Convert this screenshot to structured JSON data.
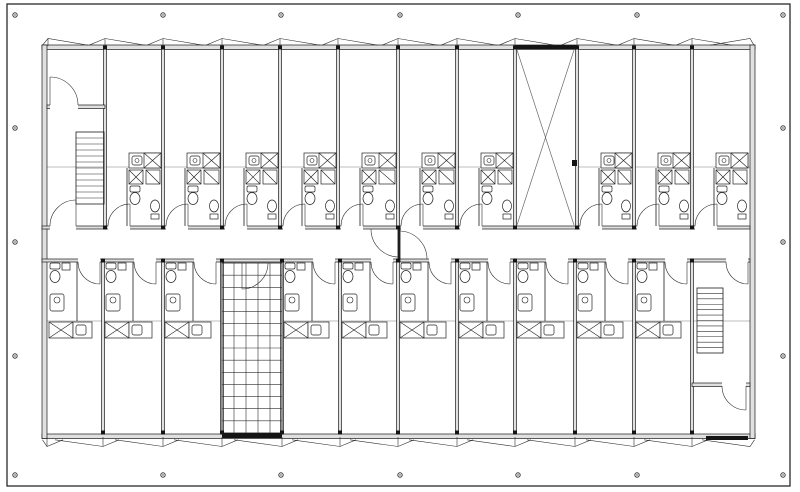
{
  "plan": {
    "kind": "architectural-floor-plan",
    "canvas": {
      "w": 800,
      "h": 492
    },
    "colors": {
      "background": "#ffffff",
      "line": "#1b1b1b",
      "wall_core": "#e0e0e0",
      "guide": "#a6a6a6",
      "solid": "#141414"
    },
    "frame": {
      "x": 7,
      "y": 4,
      "w": 783,
      "h": 482
    },
    "reg_marks": {
      "xs": [
        15,
        163,
        281,
        400,
        518,
        637,
        783
      ],
      "ys": [
        15,
        128,
        242,
        356,
        475
      ],
      "mid_ys": [
        128,
        242,
        356
      ],
      "r": 2.2
    },
    "building": {
      "x1": 42,
      "x2": 755,
      "y1": 45,
      "y2": 438.5,
      "wall_t": 4.5,
      "inner_top": 49,
      "inner_bottom": 434
    },
    "corridor": {
      "top_wall_y": 226,
      "bot_wall_y": 259,
      "wall_t": 3,
      "x1": 42,
      "x2": 750,
      "center_door_x": 397.6,
      "door_r": 28
    },
    "top_walls": [
      105,
      163,
      222,
      280,
      338,
      398,
      457,
      515,
      577,
      634,
      692
    ],
    "bottom_walls": [
      103,
      163,
      222,
      282,
      340,
      398,
      457,
      515,
      575,
      634,
      692
    ],
    "top_rooms": [
      [
        105,
        163
      ],
      [
        163,
        222
      ],
      [
        222,
        280
      ],
      [
        280,
        338
      ],
      [
        338,
        398
      ],
      [
        398,
        457
      ],
      [
        457,
        515
      ],
      [
        577,
        634
      ],
      [
        634,
        692
      ],
      [
        692,
        750
      ]
    ],
    "bottom_rooms": [
      [
        47,
        103
      ],
      [
        103,
        163
      ],
      [
        163,
        222
      ],
      [
        282,
        340
      ],
      [
        340,
        398
      ],
      [
        398,
        457
      ],
      [
        457,
        515
      ],
      [
        515,
        575
      ],
      [
        575,
        634
      ],
      [
        634,
        692
      ]
    ],
    "top_room_door": {
      "off1": 3,
      "off2": 25,
      "r": 22
    },
    "bottom_room_door": {
      "off1": 31,
      "off2": 53,
      "r": 22
    },
    "top_bath_wall_off": 22,
    "bottom_bath_wall_off": 30,
    "shaft": {
      "x1": 515,
      "x2": 577,
      "y1": 49,
      "y2": 225,
      "band_y": 45,
      "band_h": 4,
      "door": [
        572,
        160,
        5,
        6
      ]
    },
    "stair_left": {
      "bay": [
        47,
        105
      ],
      "upper_wall_y": 105,
      "upper_door": {
        "hinge": [
          50,
          105
        ],
        "r": 28
      },
      "flight": [
        76,
        132,
        28,
        72
      ],
      "treads": 11,
      "corr_door": {
        "hinge": [
          76,
          226
        ],
        "r": 26
      }
    },
    "stair_right": {
      "bay": [
        692,
        750
      ],
      "flight": [
        697,
        288,
        26,
        65
      ],
      "treads": 11,
      "corr_door": {
        "hinge": [
          748,
          262
        ],
        "r": 22
      },
      "mid_wall_y": 383,
      "mid_door": {
        "hinge": [
          746,
          386
        ],
        "r": 24
      },
      "solid": [
        706,
        436,
        42,
        4
      ]
    },
    "grid_stair": {
      "x1": 222,
      "y1": 263,
      "x2": 282,
      "y2": 433,
      "cols": 5,
      "rows": 14,
      "solid": [
        222,
        433,
        60,
        5
      ],
      "gate": {
        "hinge": [
          242,
          263
        ],
        "r": 26
      }
    },
    "guides": {
      "y_top": 167,
      "top_segments": [
        [
          47,
          515
        ],
        [
          577,
          750
        ]
      ],
      "y_bottom": 321,
      "bottom_segments": [
        [
          47,
          222
        ],
        [
          282,
          750
        ]
      ]
    },
    "windows": {
      "top_xs": [
        48,
        105,
        163,
        222,
        280,
        338,
        398,
        457,
        515,
        577,
        634,
        692
      ],
      "top_end": 750,
      "top_apex_y": 38.5,
      "top_base_y": 45.2,
      "bottom_xs": [
        47,
        103,
        163,
        222,
        282,
        340,
        398,
        457,
        515,
        575,
        634,
        692
      ],
      "bottom_end": 750,
      "bottom_apex_y": 446.5,
      "bottom_base_y": 439.8
    }
  }
}
